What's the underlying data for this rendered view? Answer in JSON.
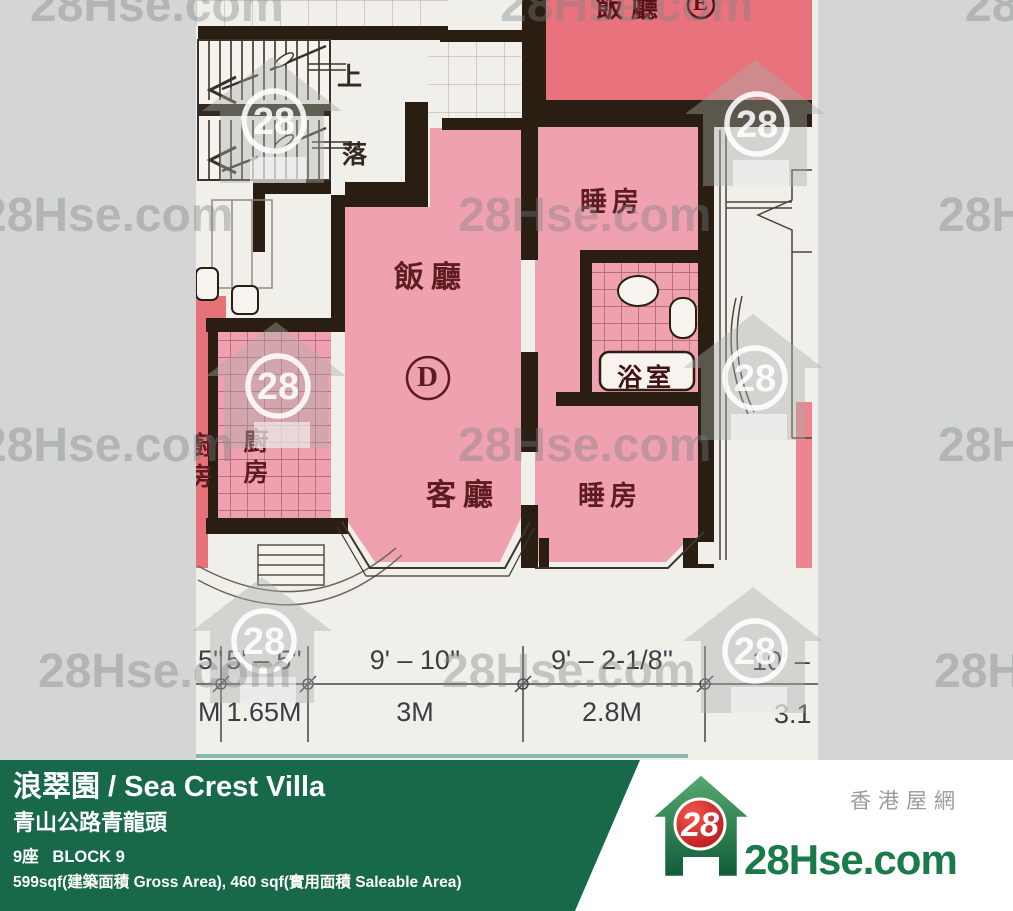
{
  "colors": {
    "background_gray": "#d3d6d4",
    "photo_paper": "#f1efe9",
    "unit_pink": "#f0a1af",
    "adjacent_red": "#e9737d",
    "wall_black": "#2a1e12",
    "banner_green": "#17694a",
    "logo_green": "#1b7a4a",
    "logo_red": "#c8151d"
  },
  "watermark": {
    "text": "28Hse.com",
    "number": "28"
  },
  "floorplan": {
    "stairs": {
      "up": "上",
      "down": "落"
    },
    "adjacent_unit": {
      "dining": "飯廳",
      "letter": "E"
    },
    "unit": {
      "letter": "D",
      "dining": "飯廳",
      "living": "客廳",
      "bedroom_top": "睡房",
      "bedroom_bottom": "睡房",
      "bathroom": "浴室",
      "kitchen": "廚房",
      "adjacent_kitchen": "廚房"
    },
    "dimensions": {
      "top": [
        "5''",
        "5' – 5''",
        "9' – 10''",
        "9' – 2-1/8''",
        "10' –"
      ],
      "bottom": [
        "M",
        "1.65M",
        "3M",
        "2.8M",
        "3.1"
      ]
    }
  },
  "banner": {
    "title": "浪翠園 / Sea Crest Villa",
    "address": "青山公路青龍頭",
    "block": "9座   BLOCK 9",
    "area": "599sqf(建築面積 Gross Area), 460 sqf(實用面積 Saleable Area)"
  },
  "logo": {
    "number": "28",
    "site": "28Hse.com",
    "tagline": "香港屋網"
  }
}
